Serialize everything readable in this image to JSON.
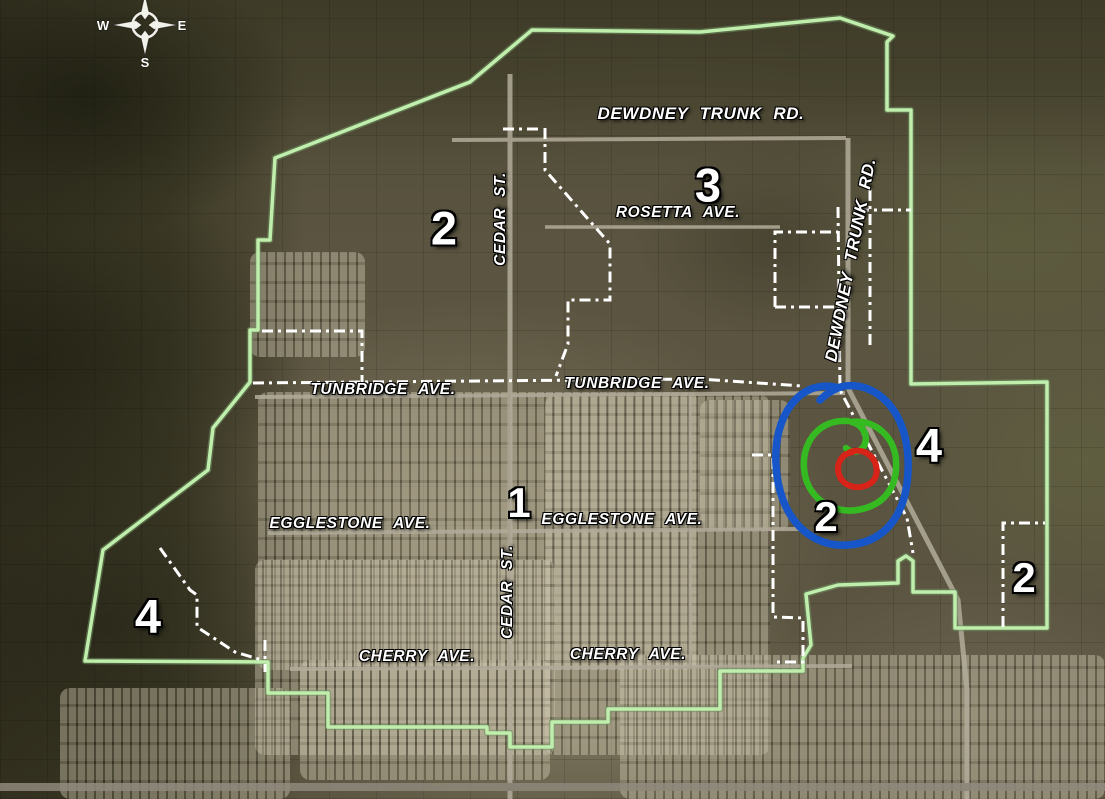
{
  "map": {
    "compass": {
      "west": "W",
      "east": "E",
      "south": "S"
    },
    "street_labels": {
      "dewdney_trunk_rd_top": "DEWDNEY TRUNK RD.",
      "rosetta_ave": "ROSETTA AVE.",
      "cedar_st_north": "CEDAR ST.",
      "cedar_st_south": "CEDAR ST.",
      "dewdney_trunk_rd_east": "DEWDNEY TRUNK RD.",
      "tunbridge_ave_west": "TUNBRIDGE AVE.",
      "tunbridge_ave_east": "TUNBRIDGE AVE.",
      "egglestone_ave_west": "EGGLESTONE AVE.",
      "egglestone_ave_east": "EGGLESTONE AVE.",
      "cherry_ave_west": "CHERRY AVE.",
      "cherry_ave_east": "CHERRY AVE."
    },
    "zone_labels": {
      "zone_2_northwest": "2",
      "zone_3_north": "3",
      "zone_1_central": "1",
      "zone_4_east": "4",
      "zone_2_circled": "2",
      "zone_2_east": "2",
      "zone_4_west": "4"
    },
    "colors": {
      "boundary_green": "#bfeead",
      "zone_line_white": "#ffffff",
      "highlight_blue": "#1656c8",
      "highlight_green": "#35bb21",
      "highlight_red": "#d82318"
    }
  }
}
